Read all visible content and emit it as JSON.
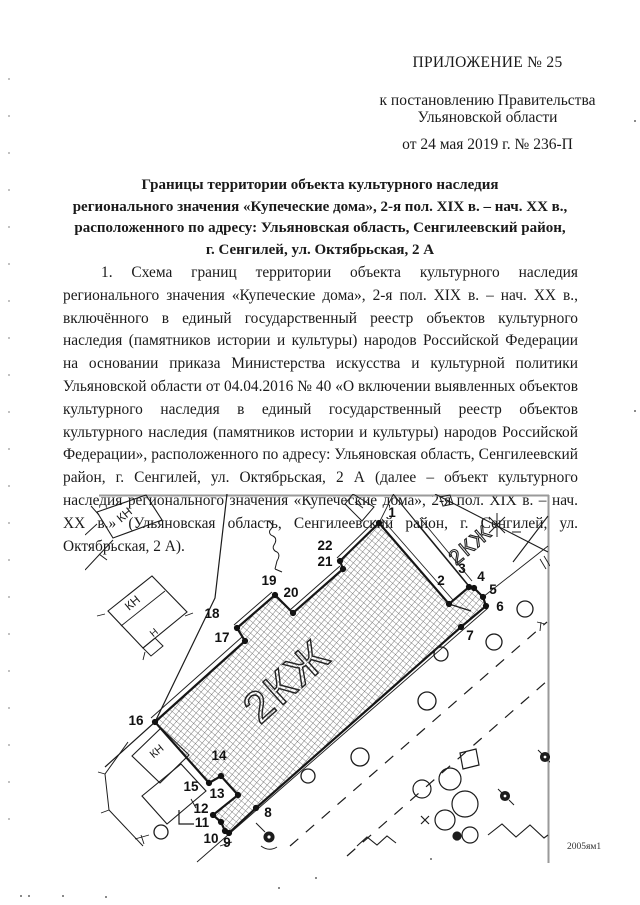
{
  "doc": {
    "appendix": "ПРИЛОЖЕНИЕ № 25",
    "subheader_lines": [
      "к постановлению Правительства",
      "Ульяновской области"
    ],
    "date_line": "от 24 мая 2019 г. № 236-П",
    "title_lines": [
      "Границы территории объекта культурного наследия",
      "регионального значения «Купеческие дома», 2-я пол. XIX в. – нач. XX в.,",
      "расположенного по адресу: Ульяновская область, Сенгилеевский район,",
      "г. Сенгилей, ул. Октябрьская, 2 А"
    ],
    "paragraph": "1. Схема границ территории объекта культурного наследия регионального значения «Купеческие дома», 2-я пол. XIX в. – нач. XX в., включённого в единый государственный реестр объектов культурного наследия (памятников истории   и культуры) народов Российской Федерации на основании приказа Министерства искусства и культурной политики Ульяновской области от 04.04.2016 № 40 «О включении выявленных объектов культурного наследия в единый государственный реестр объектов культурного наследия (памятников истории и культуры) народов Российской Федерации», расположенного по адресу: Ульяновская область, Сенгилеевский район, г. Сенгилей, ул. Октябрьская, 2 А (далее – объект культурного наследия регионального значения «Купеческие дома», 2-я пол. XIX в. – нач. XX в.» (Ульяновская область, Сенгилеевский район, г. Сенгилей, ул. Октябрьская, 2 А)."
  },
  "map": {
    "parcel_label": "2КЖ",
    "neighbor_label": "2КЖ",
    "building_labels": {
      "a": "КН",
      "b": "КН",
      "b_inner": "Н",
      "c": "КН"
    },
    "note": "2005ям1",
    "ink_color": "#1c1c1c",
    "scan_edge_color": "#9a9a9a",
    "points": [
      {
        "n": "1",
        "x": 294,
        "y": 29,
        "lx": 307,
        "ly": 23
      },
      {
        "n": "2",
        "x": 364,
        "y": 110,
        "lx": 356,
        "ly": 91
      },
      {
        "n": "3",
        "x": 384,
        "y": 93,
        "lx": 377,
        "ly": 79
      },
      {
        "n": "4",
        "x": 389,
        "y": 94,
        "lx": 396,
        "ly": 87
      },
      {
        "n": "5",
        "x": 398,
        "y": 103,
        "lx": 408,
        "ly": 100
      },
      {
        "n": "6",
        "x": 401,
        "y": 112,
        "lx": 415,
        "ly": 117
      },
      {
        "n": "7",
        "x": 376,
        "y": 133,
        "lx": 385,
        "ly": 146
      },
      {
        "n": "8",
        "x": 171,
        "y": 314,
        "lx": 183,
        "ly": 323
      },
      {
        "n": "9",
        "x": 144,
        "y": 339,
        "lx": 142,
        "ly": 353
      },
      {
        "n": "10",
        "x": 140,
        "y": 337,
        "lx": 126,
        "ly": 349
      },
      {
        "n": "11",
        "x": 136,
        "y": 328,
        "lx": 117,
        "ly": 333
      },
      {
        "n": "12",
        "x": 128,
        "y": 321,
        "lx": 116,
        "ly": 319
      },
      {
        "n": "13",
        "x": 153,
        "y": 301,
        "lx": 132,
        "ly": 304
      },
      {
        "n": "14",
        "x": 136,
        "y": 282,
        "lx": 134,
        "ly": 266
      },
      {
        "n": "15",
        "x": 124,
        "y": 289,
        "lx": 106,
        "ly": 297
      },
      {
        "n": "16",
        "x": 70,
        "y": 228,
        "lx": 51,
        "ly": 231
      },
      {
        "n": "17",
        "x": 160,
        "y": 147,
        "lx": 137,
        "ly": 148
      },
      {
        "n": "18",
        "x": 152,
        "y": 134,
        "lx": 127,
        "ly": 124
      },
      {
        "n": "19",
        "x": 190,
        "y": 101,
        "lx": 184,
        "ly": 91
      },
      {
        "n": "20",
        "x": 208,
        "y": 119,
        "lx": 206,
        "ly": 103
      },
      {
        "n": "21",
        "x": 258,
        "y": 75,
        "lx": 240,
        "ly": 72
      },
      {
        "n": "22",
        "x": 255,
        "y": 67,
        "lx": 240,
        "ly": 56
      }
    ]
  }
}
